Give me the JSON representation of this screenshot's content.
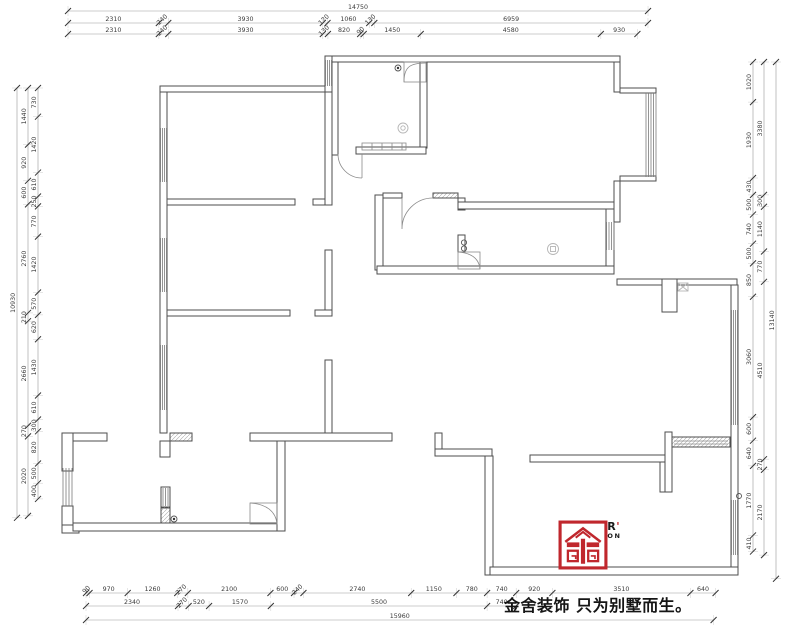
{
  "document": {
    "kind": "residential floor plan drawing"
  },
  "dimensions": {
    "top": {
      "overall": [
        "14750"
      ],
      "row2": [
        "2310",
        "240",
        "3930",
        "120",
        "1060",
        "130",
        "6959"
      ],
      "row3": [
        "2310",
        "240",
        "3930",
        "130",
        "820",
        "90",
        "1450",
        "4580",
        "930"
      ]
    },
    "bottom": {
      "row1": [
        "90",
        "970",
        "1260",
        "270",
        "2100",
        "600",
        "240",
        "2740",
        "1150",
        "780",
        "740",
        "920",
        "3510",
        "640"
      ],
      "row2": [
        "2340",
        "270",
        "520",
        "1570",
        "5500",
        "740"
      ],
      "overall": [
        "15960"
      ]
    },
    "left": {
      "overall": [
        "10930"
      ],
      "middle": [
        "1440",
        "920",
        "600",
        "2760",
        "210",
        "2660",
        "270",
        "2020"
      ],
      "inner": [
        "730",
        "1420",
        "610",
        "250",
        "770",
        "1420",
        "570",
        "620",
        "1430",
        "610",
        "300",
        "820",
        "500",
        "400"
      ]
    },
    "right": {
      "inner": [
        "1020",
        "1930",
        "430",
        "500",
        "740",
        "500",
        "850",
        "3060",
        "600",
        "640",
        "1770",
        "410"
      ],
      "middle": [
        "3380",
        "300",
        "1140",
        "770",
        "4510",
        "270",
        "2170"
      ],
      "overall": [
        "13140"
      ]
    }
  },
  "branding": {
    "logo_word": "KINGSER",
    "logo_tick": "'",
    "logo_sub": "DECORATION",
    "slogan": "金舍装饰 只为别墅而生。",
    "brand_red": "#c0272d"
  }
}
